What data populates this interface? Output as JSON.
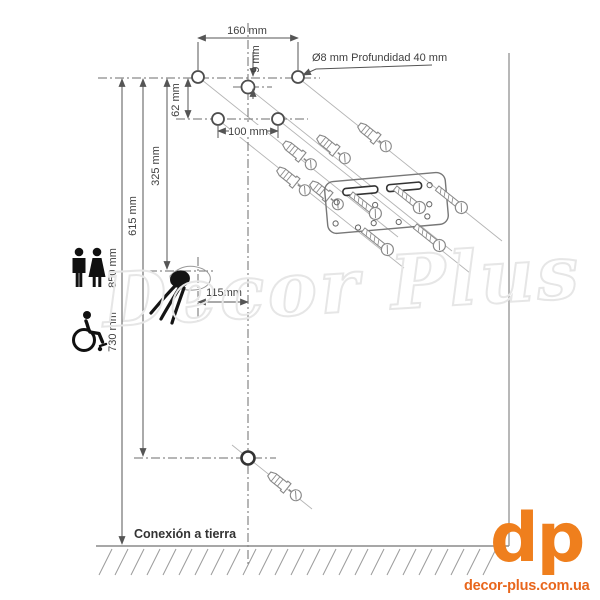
{
  "colors": {
    "brand-orange": "#ef7f1d",
    "brand-orange-dark": "#e8661c",
    "line-gray": "#8c8c8c",
    "text-gray": "#3f3f3f",
    "watermark-gray": "#e6e6e6"
  },
  "diagram": {
    "dimensions": {
      "width_160": "160 mm",
      "offset_9": "9 mm",
      "spacing_62": "62 mm",
      "width_100": "100 mm",
      "height_325": "325 mm",
      "height_615": "615 mm",
      "height_850": "850 mm",
      "height_730": "730 mm",
      "offset_115": "115mm"
    },
    "notes": {
      "drill": "Ø8 mm Profundidad 40 mm",
      "ground": "Conexión a tierra"
    }
  },
  "watermark": {
    "text": "Decor Plus"
  },
  "branding": {
    "logo_text": "dp",
    "site_text": "decor-plus.com.ua"
  }
}
